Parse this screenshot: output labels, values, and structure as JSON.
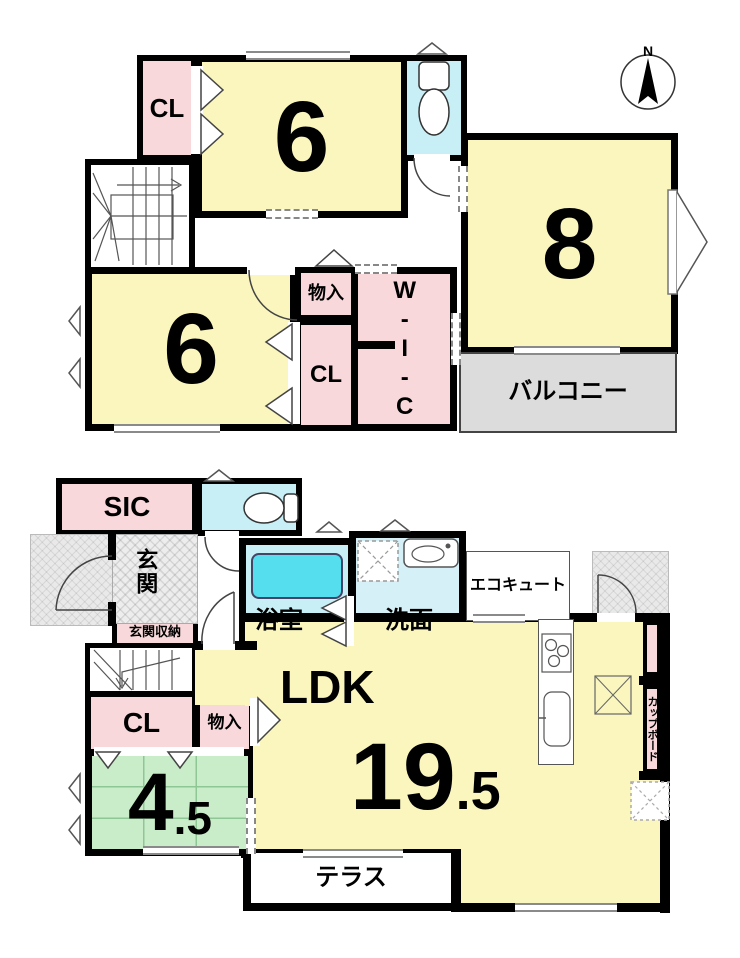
{
  "compass": {
    "north_label": "N"
  },
  "floor2": {
    "cl_top_label": "CL",
    "room6_top_value": "6",
    "room8_value": "8",
    "room6_left_value": "6",
    "monoire_label": "物入",
    "cl_mid_label": "CL",
    "wic_label": "W-I-C",
    "balcony_label": "バルコニー"
  },
  "floor1": {
    "sic_label": "SIC",
    "genkan_label": "玄関",
    "genkan_shuno_label": "玄関収納",
    "bath_label": "浴室",
    "senmen_label": "洗面",
    "ecocute_label": "エコキュート",
    "ldk_label": "LDK",
    "ldk_size_main": "19",
    "ldk_size_frac": ".5",
    "cl_label": "CL",
    "monoire_label": "物入",
    "tatami_room_main": "4",
    "tatami_room_frac": ".5",
    "terrace_label": "テラス",
    "cupboard_label": "カップボード"
  },
  "colors": {
    "room_yellow": "#FAF6BE",
    "closet_pink": "#F8D8DA",
    "wet_cyan": "#C9EFF6",
    "bathtub_cyan": "#55DFEE",
    "tatami_green": "#C9ECC9",
    "balcony_gray": "#DCDCDC",
    "wall_black": "#000000"
  }
}
